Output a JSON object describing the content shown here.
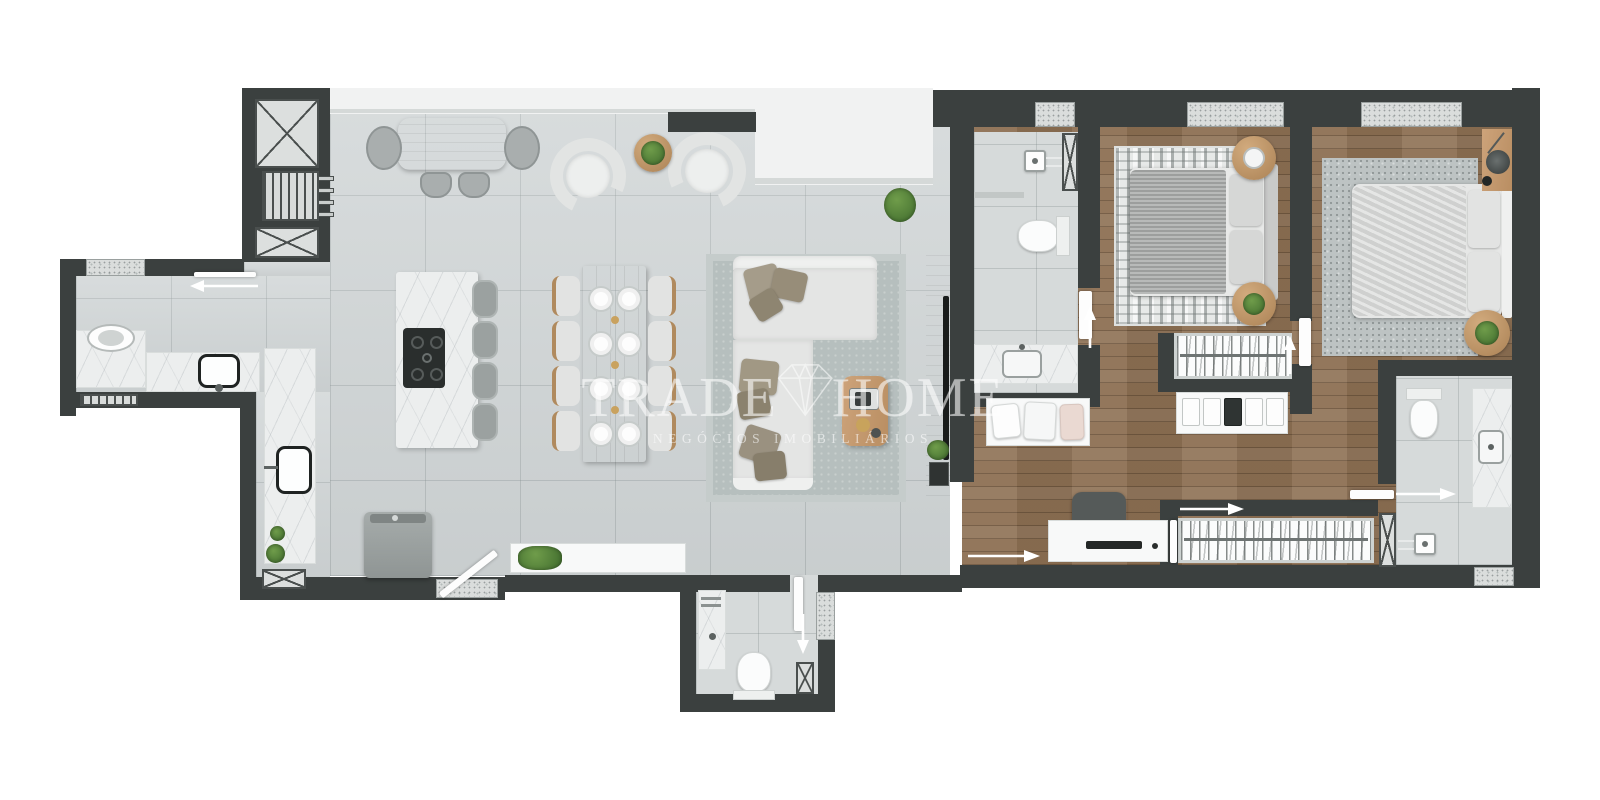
{
  "watermark": {
    "title_left": "TRADE",
    "title_right": "HOME",
    "subtitle": "NEGÓCIOS IMOBILIÁRIOS",
    "icon": "diamond-outline-icon"
  },
  "palette": {
    "wall": "#3b403f",
    "tile_floor": "#cfd4d5",
    "bath_tile_floor": "#d6dada",
    "wood_floor": "#8d7053",
    "marble_counter": "#eceeee",
    "granite_sill": "#dadddc",
    "balcony_floor": "#f1f2f2",
    "furniture_wood": "#c49a6c",
    "sofa_fabric": "#e4e5e4",
    "pillow_taupe": "#a59c8a",
    "watermark_text": "#ffffff"
  }
}
